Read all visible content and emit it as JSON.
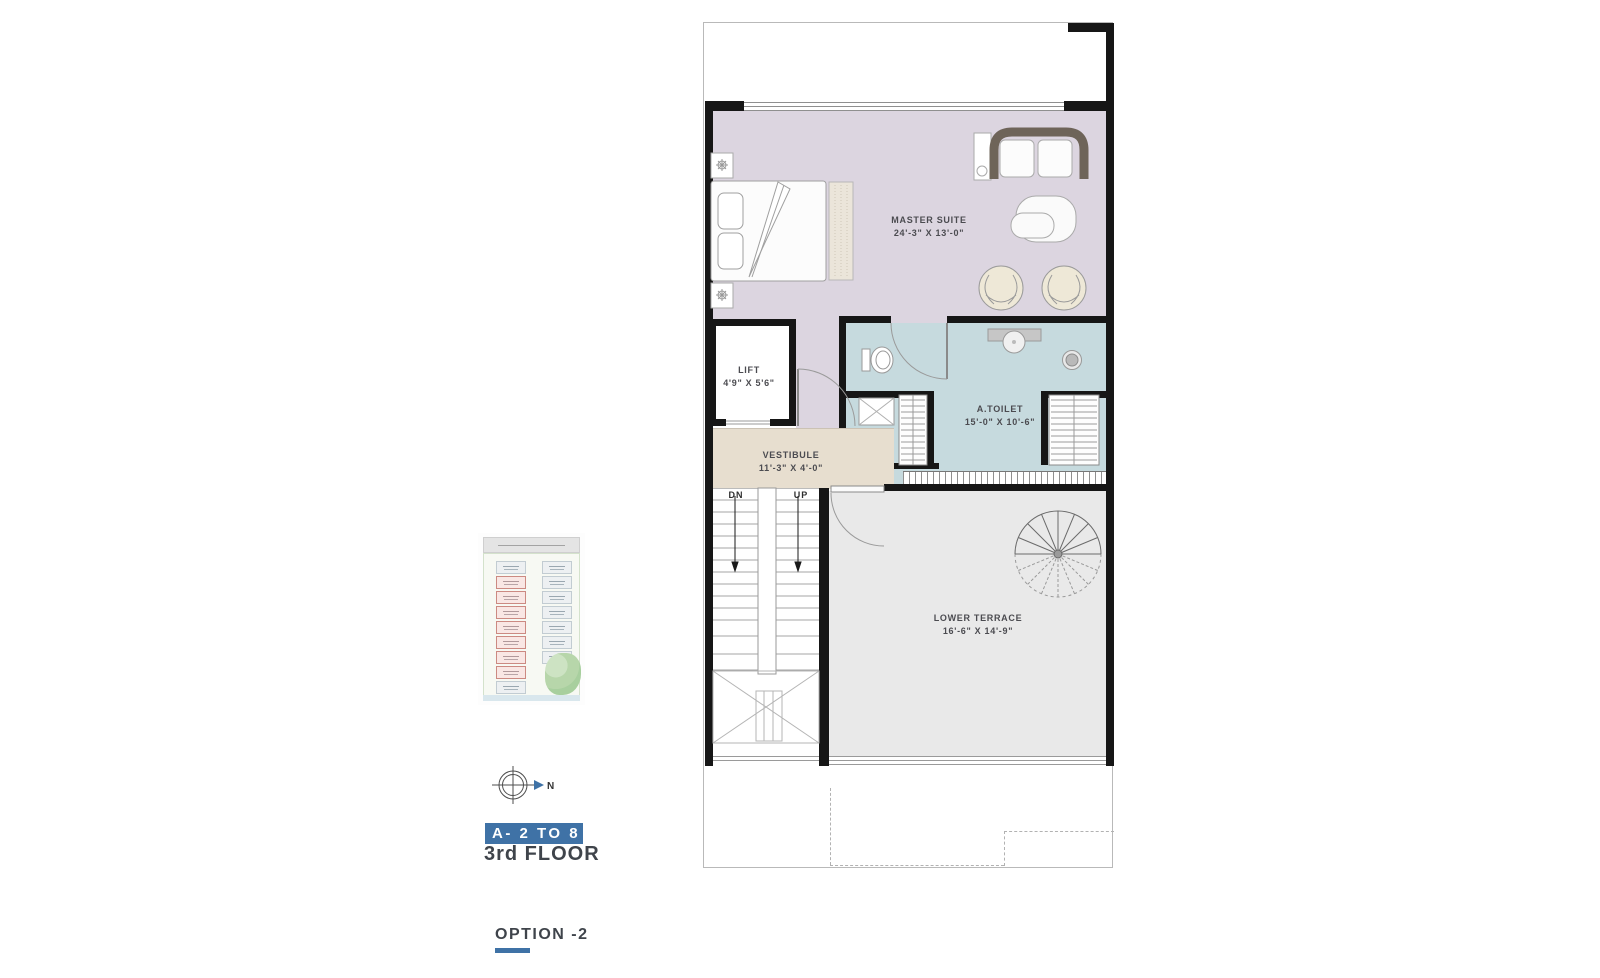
{
  "plan": {
    "rooms": {
      "master_suite": {
        "name": "MASTER SUITE",
        "dims": "24'-3\" X 13'-0\""
      },
      "lift": {
        "name": "LIFT",
        "dims": "4'9\" X 5'6\""
      },
      "toilet": {
        "name": "A.TOILET",
        "dims": "15'-0\" X 10'-6\""
      },
      "vestibule": {
        "name": "VESTIBULE",
        "dims": "11'-3\" X 4'-0\""
      },
      "lower_terrace": {
        "name": "LOWER TERRACE",
        "dims": "16'-6\" X 14'-9\""
      }
    },
    "stairs": {
      "down_label": "DN",
      "up_label": "UP"
    }
  },
  "legend": {
    "compass_north_label": "N",
    "unit_range_label": "A- 2 TO 8",
    "floor_label": "3rd FLOOR",
    "option_label": "OPTION -2"
  },
  "colors": {
    "accent_blue": "#3f72a6",
    "wall": "#161616",
    "master_suite_fill": "#dcd5e0",
    "toilet_fill": "#c6dade",
    "vestibule_fill": "#e7decf",
    "terrace_fill": "#e9e9e9"
  }
}
